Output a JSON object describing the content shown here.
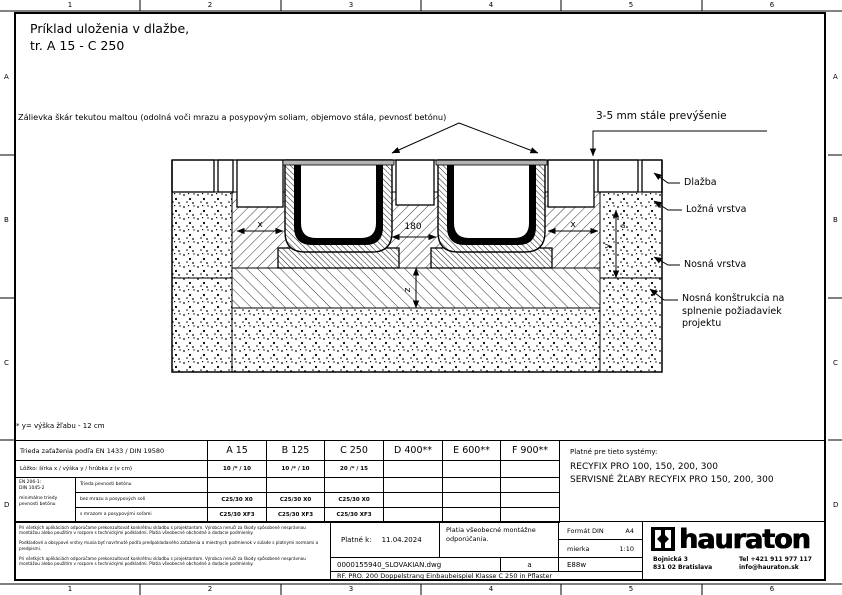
{
  "ruler": {
    "cols": [
      "1",
      "2",
      "3",
      "4",
      "5",
      "6"
    ],
    "rows": [
      "A",
      "B",
      "C",
      "D"
    ]
  },
  "title": {
    "line1": "Príklad uloženia v dlažbe,",
    "line2": "tr. A 15 - C 250"
  },
  "annotations": {
    "grout": "Zálievka škár tekutou maltou (odolná voči mrazu a posypovým soliam, objemovo stála, pevnosť betónu)",
    "overfill": "3-5 mm stále prevýšenie",
    "layer1": "Dlažba",
    "layer2": "Ložná vrstva",
    "layer3": "Nosná vrstva",
    "layer4": "Nosná konštrukcia na splnenie požiadaviek projektu"
  },
  "dims": {
    "x_left": "x",
    "center": "180",
    "x_right": "x",
    "y": "y",
    "z": "z",
    "a": "a"
  },
  "footnote": "* y= výška žľabu - 12 cm",
  "table": {
    "load_class_label": "Trieda zaťaženia podľa EN 1433 / DIN 19580",
    "classes": [
      "A 15",
      "B 125",
      "C 250",
      "D 400**",
      "E 600**",
      "F 900**"
    ],
    "bed_label": "Lôžko: šírka x / výška y / hrúbka z (v cm)",
    "bed_values": [
      "10 /* / 10",
      "10 /* / 10",
      "20 /* / 15",
      "",
      "",
      ""
    ],
    "concrete_norm1": "EN 206-1:",
    "concrete_norm2": "DIN 1045-2",
    "concrete_norm3": "minimálne triedy pevnosti betónu",
    "rows": [
      {
        "label": "Trieda pevnosti betónu",
        "values": [
          "",
          "",
          "",
          "",
          "",
          ""
        ]
      },
      {
        "label": "bez mrazu a posypových solí",
        "values": [
          "C25/30 X0",
          "C25/30 X0",
          "C25/30 X0",
          "",
          "",
          ""
        ]
      },
      {
        "label": "s mrazom a posypovými soľami",
        "values": [
          "C25/30 XF3",
          "C25/30 XF3",
          "C25/30 XF3",
          "",
          "",
          ""
        ]
      }
    ]
  },
  "systems": {
    "intro": "Platné pre tieto systémy:",
    "line1": "RECYFIX PRO 100, 150, 200, 300",
    "line2": "SERVISNÉ ŽĽABY RECYFIX PRO 150, 200, 300"
  },
  "titleblock": {
    "disclaimer1": "Pri všetkých aplikáciách odporúčame prekonzultovať konkrétnu skladbu s projektantom. Výrobca neručí za škody spôsobené nesprávnou montážou alebo použitím v rozpore s technickými podkladmi. Platia všeobecné obchodné a dodacie podmienky.",
    "disclaimer2": "Podkladové a obsypové vrstvy musia byť navrhnuté podľa predpokladaného zaťaženia a miestnych podmienok v súlade s platnými normami a predpismi.",
    "disclaimer3": "Pri všetkých aplikáciách odporúčame prekonzultovať konkrétnu skladbu s projektantom. Výrobca neručí za škody spôsobené nesprávnou montážou alebo použitím v rozpore s technickými podkladmi. Platia všeobecné obchodné a dodacie podmienky.",
    "valid_label": "Platné k:",
    "valid_date": "11.04.2024",
    "note": "Platia všeobecné montážne odporúčania.",
    "format_label": "Formát DIN",
    "format_value": "A4",
    "scale_label": "mierka",
    "scale_value": "1:10",
    "filename": "0000155940_SLOVAKIAN.dwg",
    "revision": "a",
    "code": "E88w",
    "description": "RF. PRO. 200 Doppelstrang Einbaubeispiel Klasse C 250 in Pflaster",
    "brand": "hauraton",
    "address1": "Bojnická 3",
    "address2": "831 02 Bratislava",
    "phone": "Tel +421 911 977 117",
    "email": "info@hauraton.sk"
  }
}
